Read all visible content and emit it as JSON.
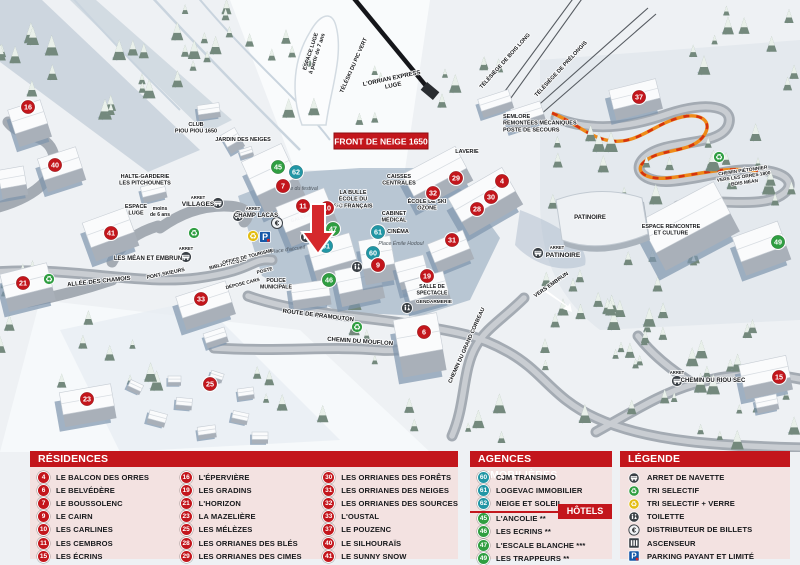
{
  "colors": {
    "red": "#c3161c",
    "teal": "#2196a5",
    "green": "#2f9e41",
    "orange": "#ef8a18",
    "parking_blue": "#1558a8"
  },
  "map": {
    "banner": "FRONT DE NEIGE 1650",
    "markers": [
      {
        "n": "16",
        "x": 28,
        "y": 107,
        "t": "res"
      },
      {
        "n": "40",
        "x": 55,
        "y": 165,
        "t": "res"
      },
      {
        "n": "41",
        "x": 111,
        "y": 233,
        "t": "res"
      },
      {
        "n": "21",
        "x": 23,
        "y": 283,
        "t": "res"
      },
      {
        "n": "33",
        "x": 201,
        "y": 299,
        "t": "res"
      },
      {
        "n": "23",
        "x": 87,
        "y": 399,
        "t": "res"
      },
      {
        "n": "25",
        "x": 210,
        "y": 384,
        "t": "res"
      },
      {
        "n": "45",
        "x": 278,
        "y": 167,
        "t": "hotel"
      },
      {
        "n": "62",
        "x": 296,
        "y": 172,
        "t": "agency"
      },
      {
        "n": "7",
        "x": 283,
        "y": 186,
        "t": "res"
      },
      {
        "n": "11",
        "x": 303,
        "y": 206,
        "t": "res"
      },
      {
        "n": "10",
        "x": 327,
        "y": 208,
        "t": "res"
      },
      {
        "n": "47",
        "x": 333,
        "y": 229,
        "t": "hotel"
      },
      {
        "n": "61",
        "x": 326,
        "y": 246,
        "t": "agency"
      },
      {
        "n": "61",
        "x": 378,
        "y": 232,
        "t": "agency"
      },
      {
        "n": "60",
        "x": 373,
        "y": 253,
        "t": "agency"
      },
      {
        "n": "9",
        "x": 378,
        "y": 265,
        "t": "res"
      },
      {
        "n": "46",
        "x": 329,
        "y": 280,
        "t": "hotel"
      },
      {
        "n": "19",
        "x": 427,
        "y": 276,
        "t": "res"
      },
      {
        "n": "6",
        "x": 424,
        "y": 332,
        "t": "res"
      },
      {
        "n": "29",
        "x": 456,
        "y": 178,
        "t": "res"
      },
      {
        "n": "4",
        "x": 502,
        "y": 181,
        "t": "res"
      },
      {
        "n": "32",
        "x": 433,
        "y": 193,
        "t": "res"
      },
      {
        "n": "30",
        "x": 491,
        "y": 197,
        "t": "res"
      },
      {
        "n": "28",
        "x": 477,
        "y": 209,
        "t": "res"
      },
      {
        "n": "31",
        "x": 452,
        "y": 240,
        "t": "res"
      },
      {
        "n": "37",
        "x": 639,
        "y": 97,
        "t": "res"
      },
      {
        "n": "49",
        "x": 778,
        "y": 242,
        "t": "hotel"
      },
      {
        "n": "15",
        "x": 779,
        "y": 377,
        "t": "res"
      }
    ],
    "labels": [
      {
        "t": "CLUB\nPIOU PIOU 1650",
        "x": 196,
        "y": 126,
        "s": 5.5
      },
      {
        "t": "JARDIN DES NEIGES",
        "x": 243,
        "y": 141,
        "s": 5.5
      },
      {
        "t": "HALTE-GARDERIE\nLES PITCHOUNETS",
        "x": 145,
        "y": 178,
        "s": 5.5
      },
      {
        "t": "ESPACE\nLUGE",
        "x": 136,
        "y": 208,
        "s": 5.5
      },
      {
        "t": "moins\nde 6 ans",
        "x": 160,
        "y": 210,
        "s": 5
      },
      {
        "t": "ESPACE LUGE\nà partir de 7 ans",
        "x": 312,
        "y": 52,
        "s": 5.5,
        "r": -72
      },
      {
        "t": "TÉLÉSKI DU PIC VERT",
        "x": 355,
        "y": 66,
        "s": 5.5,
        "r": -66
      },
      {
        "t": "L'ORRIAN EXPRESS\nLUGE",
        "x": 392,
        "y": 80,
        "s": 6,
        "r": -12
      },
      {
        "t": "TÉLÉSIÈGE DE BOIS LONG",
        "x": 506,
        "y": 62,
        "s": 5.5,
        "r": -48
      },
      {
        "t": "TÉLÉSIÈGE DE PRÉLONGIS",
        "x": 562,
        "y": 70,
        "s": 5.5,
        "r": -47
      },
      {
        "t": "SEMLORE\nREMONTÉES MÉCANIQUES\nPOSTE DE SECOURS",
        "x": 503,
        "y": 118,
        "s": 5.5,
        "k": "left"
      },
      {
        "t": "LAVERIE",
        "x": 467,
        "y": 153,
        "s": 5.5
      },
      {
        "t": "CAISSES\nCENTRALES",
        "x": 399,
        "y": 178,
        "s": 5.5
      },
      {
        "t": "ÉCOLE DE SKI\nOZONE",
        "x": 427,
        "y": 203,
        "s": 5.5
      },
      {
        "t": "CABINET\nMÉDICAL",
        "x": 394,
        "y": 215,
        "s": 5.5
      },
      {
        "t": "CINÉMA",
        "x": 398,
        "y": 233,
        "s": 5.5
      },
      {
        "t": "Place Émile Hodoul",
        "x": 401,
        "y": 245,
        "s": 5.2,
        "k": "it"
      },
      {
        "t": "Place du festival",
        "x": 299,
        "y": 190,
        "s": 5.2,
        "k": "it"
      },
      {
        "t": "LA BULLE\nÉCOLE DU\nSKI FRANÇAIS",
        "x": 353,
        "y": 194,
        "s": 5.5
      },
      {
        "t": "GALERIE MARCHANDE",
        "x": 317,
        "y": 214,
        "s": 4.8,
        "k": "wh",
        "r": -18
      },
      {
        "t": "ARRET",
        "x": 253,
        "y": 210,
        "s": 4.2
      },
      {
        "t": "CHAMP LACAS",
        "x": 256,
        "y": 217,
        "s": 6
      },
      {
        "t": "ARRET",
        "x": 198,
        "y": 199,
        "s": 4.2
      },
      {
        "t": "VILLAGES",
        "x": 198,
        "y": 206,
        "s": 6.5
      },
      {
        "t": "ARRET",
        "x": 186,
        "y": 250,
        "s": 4.2
      },
      {
        "t": "LES MÉAN ET EMBRUN",
        "x": 148,
        "y": 260,
        "s": 6
      },
      {
        "t": "ALLÉE DES CHAMOIS",
        "x": 99,
        "y": 283,
        "s": 6,
        "r": -6
      },
      {
        "t": "PONT SKIEURS",
        "x": 166,
        "y": 275,
        "s": 5.2,
        "r": -12
      },
      {
        "t": "BIBLIOTHÈQUE",
        "x": 228,
        "y": 265,
        "s": 5,
        "r": -14
      },
      {
        "t": "OFFICE DE TOURISME",
        "x": 248,
        "y": 258,
        "s": 4.8,
        "r": -14
      },
      {
        "t": "POSTE",
        "x": 265,
        "y": 272,
        "s": 4.8,
        "r": -14
      },
      {
        "t": "DÉPOSE CARS",
        "x": 243,
        "y": 285,
        "s": 4.8,
        "r": -14
      },
      {
        "t": "POLICE\nMUNICIPALE",
        "x": 276,
        "y": 282,
        "s": 5.2
      },
      {
        "t": "Place d'accueil",
        "x": 288,
        "y": 251,
        "s": 5.2,
        "k": "it",
        "r": -8
      },
      {
        "t": "ROUTE DE PRAMOUTON",
        "x": 318,
        "y": 317,
        "s": 6,
        "r": 7
      },
      {
        "t": "CHEMIN DU MOUFLON",
        "x": 360,
        "y": 343,
        "s": 6,
        "r": 4
      },
      {
        "t": "CHEMIN DU GRAND CORBEAU",
        "x": 468,
        "y": 346,
        "s": 5.5,
        "r": -66
      },
      {
        "t": "SALLE DE\nSPECTACLE",
        "x": 432,
        "y": 288,
        "s": 5.2
      },
      {
        "t": "GENDARMERIE",
        "x": 434,
        "y": 303,
        "s": 4.8
      },
      {
        "t": "PATINOIRE",
        "x": 590,
        "y": 219,
        "s": 6
      },
      {
        "t": "ARRET",
        "x": 557,
        "y": 249,
        "s": 4.2
      },
      {
        "t": "PATINOIRE",
        "x": 563,
        "y": 257,
        "s": 6.5
      },
      {
        "t": "ESPACE RENCONTRE\nET CULTURE",
        "x": 671,
        "y": 228,
        "s": 5.5
      },
      {
        "t": "VERS EMBRUN",
        "x": 552,
        "y": 286,
        "s": 5.5,
        "r": -35
      },
      {
        "t": "CHEMIN PIÉTONNIER\nVERS LES ORRES 1800\nBOIS MÉAN",
        "x": 743,
        "y": 172,
        "s": 4.8,
        "r": -8
      },
      {
        "t": "ARRET",
        "x": 677,
        "y": 374,
        "s": 4.2
      },
      {
        "t": "CHEMIN DU RIOU SEC",
        "x": 713,
        "y": 382,
        "s": 6
      }
    ],
    "icons": [
      {
        "type": "bus",
        "x": 238,
        "y": 216
      },
      {
        "type": "bus",
        "x": 218,
        "y": 203
      },
      {
        "type": "bus",
        "x": 186,
        "y": 257
      },
      {
        "type": "bus",
        "x": 538,
        "y": 253
      },
      {
        "type": "bus",
        "x": 677,
        "y": 381
      },
      {
        "type": "recycle-green",
        "x": 49,
        "y": 279
      },
      {
        "type": "recycle-green",
        "x": 194,
        "y": 233
      },
      {
        "type": "recycle-green",
        "x": 357,
        "y": 327
      },
      {
        "type": "recycle-green",
        "x": 719,
        "y": 157
      },
      {
        "type": "recycle-yellow",
        "x": 253,
        "y": 236
      },
      {
        "type": "euro",
        "x": 277,
        "y": 223
      },
      {
        "type": "parking",
        "x": 265,
        "y": 237
      },
      {
        "type": "toilet",
        "x": 306,
        "y": 237
      },
      {
        "type": "toilet",
        "x": 357,
        "y": 267
      },
      {
        "type": "toilet",
        "x": 407,
        "y": 308
      }
    ]
  },
  "legend": {
    "residences": {
      "title": "RÉSIDENCES",
      "columns": [
        [
          {
            "n": "4",
            "label": "LE BALCON DES ORRES"
          },
          {
            "n": "6",
            "label": "LE BELVÉDÈRE"
          },
          {
            "n": "7",
            "label": "LE BOUSSOLENC"
          },
          {
            "n": "9",
            "label": "LE CAIRN"
          },
          {
            "n": "10",
            "label": "LES CARLINES"
          },
          {
            "n": "11",
            "label": "LES CEMBROS"
          },
          {
            "n": "15",
            "label": "LES ÉCRINS"
          }
        ],
        [
          {
            "n": "16",
            "label": "L'ÉPERVIÈRE"
          },
          {
            "n": "19",
            "label": "LES GRADINS"
          },
          {
            "n": "21",
            "label": "L'HORIZON"
          },
          {
            "n": "23",
            "label": "LA MAZELIÈRE"
          },
          {
            "n": "25",
            "label": "LES MÉLÈZES"
          },
          {
            "n": "28",
            "label": "LES ORRIANES DES BLÉS"
          },
          {
            "n": "29",
            "label": "LES ORRIANES DES CIMES"
          }
        ],
        [
          {
            "n": "30",
            "label": "LES ORRIANES DES FORÊTS"
          },
          {
            "n": "31",
            "label": "LES ORRIANES DES NEIGES"
          },
          {
            "n": "32",
            "label": "LES ORRIANES DES SOURCES"
          },
          {
            "n": "33",
            "label": "L'OUSTAL"
          },
          {
            "n": "37",
            "label": "LE POUZENC"
          },
          {
            "n": "40",
            "label": "LE SILHOURAÏS"
          },
          {
            "n": "41",
            "label": "LE SUNNY SNOW"
          }
        ]
      ]
    },
    "agences": {
      "title": "AGENCES IMMOBILIÈRES",
      "items": [
        {
          "n": "60",
          "label": "CJM TRANSIMO"
        },
        {
          "n": "61",
          "label": "LOGEVAC IMMOBILIER"
        },
        {
          "n": "62",
          "label": "NEIGE ET SOLEIL"
        }
      ]
    },
    "hotels": {
      "title": "HÔTELS",
      "items": [
        {
          "n": "45",
          "label": "L'ANCOLIE **"
        },
        {
          "n": "46",
          "label": "LES ECRINS **"
        },
        {
          "n": "47",
          "label": "L'ESCALE BLANCHE ***"
        },
        {
          "n": "49",
          "label": "LES TRAPPEURS **"
        }
      ]
    },
    "legende": {
      "title": "LÉGENDE",
      "items": [
        {
          "icon": "bus",
          "label": "ARRET DE NAVETTE"
        },
        {
          "icon": "recycle-green",
          "label": "TRI SELECTIF"
        },
        {
          "icon": "recycle-yellow",
          "label": "TRI SELECTIF + VERRE"
        },
        {
          "icon": "toilet",
          "label": "TOILETTE"
        },
        {
          "icon": "euro",
          "label": "DISTRIBUTEUR DE BILLETS"
        },
        {
          "icon": "elevator",
          "label": "ASCENSEUR"
        },
        {
          "icon": "parking",
          "label": "PARKING PAYANT ET LIMITÉ"
        }
      ]
    }
  }
}
